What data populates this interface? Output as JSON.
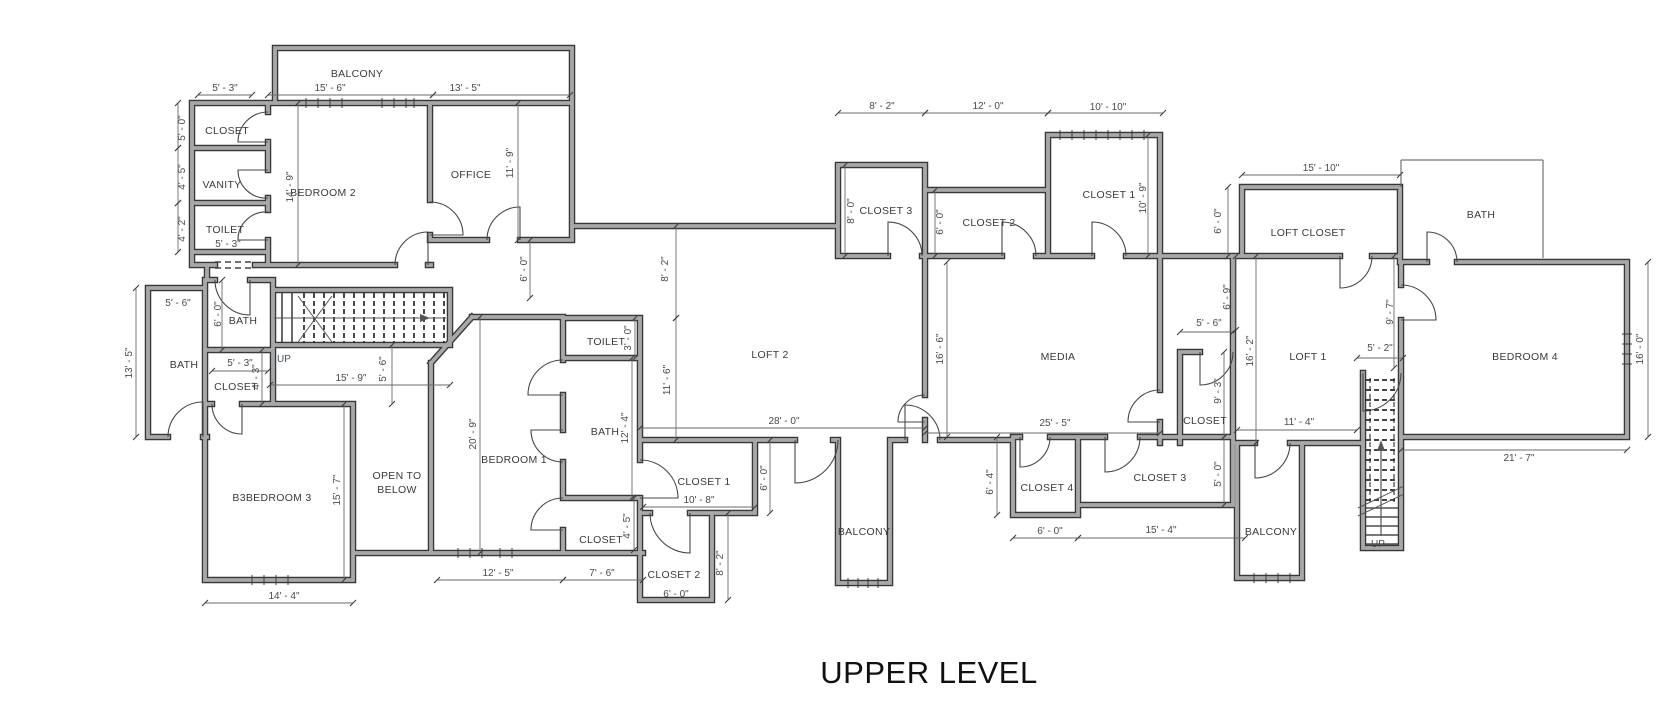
{
  "title": {
    "text": "UPPER LEVEL"
  },
  "colors": {
    "background": "#ffffff",
    "wall_edge": "#383838",
    "wall_core": "#a8a8a8",
    "thin_line": "#555555",
    "dim_text": "#4a4a4a",
    "room_text": "#3a3a3a"
  },
  "rooms": [
    {
      "label": "BALCONY",
      "x": 357,
      "y": 77
    },
    {
      "label": "CLOSET",
      "x": 227,
      "y": 134
    },
    {
      "label": "VANITY",
      "x": 222,
      "y": 188
    },
    {
      "label": "TOILET",
      "x": 225,
      "y": 233
    },
    {
      "label": "BEDROOM 2",
      "x": 323,
      "y": 196
    },
    {
      "label": "OFFICE",
      "x": 471,
      "y": 178
    },
    {
      "label": "BATH",
      "x": 243,
      "y": 324
    },
    {
      "label": "BATH",
      "x": 184,
      "y": 368
    },
    {
      "label": "CLOSET",
      "x": 236,
      "y": 390
    },
    {
      "label": "B3BEDROOM 3",
      "x": 272,
      "y": 501
    },
    {
      "label": "OPEN TO",
      "x": 397,
      "y": 479
    },
    {
      "label": "BELOW",
      "x": 397,
      "y": 493
    },
    {
      "label": "BEDROOM 1",
      "x": 514,
      "y": 463
    },
    {
      "label": "TOILET",
      "x": 606,
      "y": 345
    },
    {
      "label": "BATH",
      "x": 605,
      "y": 435
    },
    {
      "label": "CLOSET",
      "x": 601,
      "y": 543
    },
    {
      "label": "CLOSET 1",
      "x": 704,
      "y": 485
    },
    {
      "label": "10' - 8\"",
      "x": 699,
      "y": 503,
      "dimstyle": true
    },
    {
      "label": "CLOSET 2",
      "x": 674,
      "y": 578
    },
    {
      "label": "6' - 0\"",
      "x": 676,
      "y": 597,
      "dimstyle": true
    },
    {
      "label": "LOFT 2",
      "x": 770,
      "y": 358
    },
    {
      "label": "CLOSET 3",
      "x": 886,
      "y": 214
    },
    {
      "label": "CLOSET 2",
      "x": 989,
      "y": 226
    },
    {
      "label": "CLOSET 1",
      "x": 1109,
      "y": 198
    },
    {
      "label": "MEDIA",
      "x": 1058,
      "y": 360
    },
    {
      "label": "BALCONY",
      "x": 864,
      "y": 535
    },
    {
      "label": "CLOSET 4",
      "x": 1047,
      "y": 491
    },
    {
      "label": "CLOSET 3",
      "x": 1160,
      "y": 481
    },
    {
      "label": "CLOSET",
      "x": 1205,
      "y": 424
    },
    {
      "label": "LOFT CLOSET",
      "x": 1308,
      "y": 236
    },
    {
      "label": "LOFT 1",
      "x": 1308,
      "y": 360
    },
    {
      "label": "BALCONY",
      "x": 1271,
      "y": 535
    },
    {
      "label": "BATH",
      "x": 1481,
      "y": 218
    },
    {
      "label": "BEDROOM 4",
      "x": 1525,
      "y": 360
    }
  ],
  "dimensions": [
    {
      "label": "5' - 3\"",
      "x": 225,
      "y": 91,
      "rot": 0
    },
    {
      "label": "15' - 6\"",
      "x": 330,
      "y": 91,
      "rot": 0
    },
    {
      "label": "13' - 5\"",
      "x": 465,
      "y": 91,
      "rot": 0
    },
    {
      "label": "5' - 3\"",
      "x": 228,
      "y": 247,
      "rot": 0
    },
    {
      "label": "5' - 6\"",
      "x": 178,
      "y": 306,
      "rot": 0
    },
    {
      "label": "5' - 3\"",
      "x": 240,
      "y": 366,
      "rot": 0
    },
    {
      "label": "15' - 9\"",
      "x": 351,
      "y": 381,
      "rot": 0
    },
    {
      "label": "14' - 4\"",
      "x": 284,
      "y": 599,
      "rot": 0
    },
    {
      "label": "12' - 5\"",
      "x": 498,
      "y": 576,
      "rot": 0
    },
    {
      "label": "7' - 6\"",
      "x": 602,
      "y": 576,
      "rot": 0
    },
    {
      "label": "28' - 0\"",
      "x": 784,
      "y": 424,
      "rot": 0
    },
    {
      "label": "8' - 2\"",
      "x": 882,
      "y": 109,
      "rot": 0
    },
    {
      "label": "12' - 0\"",
      "x": 988,
      "y": 109,
      "rot": 0
    },
    {
      "label": "10' - 10\"",
      "x": 1108,
      "y": 110,
      "rot": 0
    },
    {
      "label": "25' - 5\"",
      "x": 1055,
      "y": 426,
      "rot": 0
    },
    {
      "label": "6' - 0\"",
      "x": 1050,
      "y": 534,
      "rot": 0
    },
    {
      "label": "15' - 4\"",
      "x": 1161,
      "y": 533,
      "rot": 0
    },
    {
      "label": "5' - 6\"",
      "x": 1209,
      "y": 326,
      "rot": 0
    },
    {
      "label": "15' - 10\"",
      "x": 1321,
      "y": 171,
      "rot": 0
    },
    {
      "label": "5' - 2\"",
      "x": 1380,
      "y": 351,
      "rot": 0
    },
    {
      "label": "11' - 4\"",
      "x": 1299,
      "y": 425,
      "rot": 0
    },
    {
      "label": "21' - 7\"",
      "x": 1519,
      "y": 461,
      "rot": 0
    },
    {
      "label": "5' - 0\"",
      "x": 185,
      "y": 128,
      "rot": 1
    },
    {
      "label": "4' - 5\"",
      "x": 185,
      "y": 177,
      "rot": 1
    },
    {
      "label": "4' - 2\"",
      "x": 185,
      "y": 229,
      "rot": 1
    },
    {
      "label": "14' - 9\"",
      "x": 293,
      "y": 187,
      "rot": 1
    },
    {
      "label": "11' - 9\"",
      "x": 513,
      "y": 163,
      "rot": 1
    },
    {
      "label": "6' - 0\"",
      "x": 527,
      "y": 269,
      "rot": 1
    },
    {
      "label": "6' - 0\"",
      "x": 221,
      "y": 314,
      "rot": 1
    },
    {
      "label": "13' - 5\"",
      "x": 132,
      "y": 363,
      "rot": 1
    },
    {
      "label": "4' - 3\"",
      "x": 259,
      "y": 377,
      "rot": 1
    },
    {
      "label": "5' - 6\"",
      "x": 386,
      "y": 369,
      "rot": 1
    },
    {
      "label": "15' - 7\"",
      "x": 340,
      "y": 490,
      "rot": 1
    },
    {
      "label": "20' - 9\"",
      "x": 476,
      "y": 434,
      "rot": 1
    },
    {
      "label": "3' - 0\"",
      "x": 631,
      "y": 338,
      "rot": 1
    },
    {
      "label": "12' - 4\"",
      "x": 628,
      "y": 428,
      "rot": 1
    },
    {
      "label": "4' - 5\"",
      "x": 630,
      "y": 526,
      "rot": 1
    },
    {
      "label": "8' - 2\"",
      "x": 668,
      "y": 269,
      "rot": 1
    },
    {
      "label": "11' - 6\"",
      "x": 670,
      "y": 380,
      "rot": 1
    },
    {
      "label": "6' - 0\"",
      "x": 767,
      "y": 478,
      "rot": 1
    },
    {
      "label": "8' - 2\"",
      "x": 723,
      "y": 563,
      "rot": 1
    },
    {
      "label": "8' - 0\"",
      "x": 854,
      "y": 211,
      "rot": 1
    },
    {
      "label": "6' - 0\"",
      "x": 943,
      "y": 222,
      "rot": 1
    },
    {
      "label": "10' - 9\"",
      "x": 1146,
      "y": 198,
      "rot": 1
    },
    {
      "label": "16' - 6\"",
      "x": 943,
      "y": 349,
      "rot": 1
    },
    {
      "label": "16' - 2\"",
      "x": 1253,
      "y": 351,
      "rot": 1
    },
    {
      "label": "6' - 4\"",
      "x": 993,
      "y": 482,
      "rot": 1
    },
    {
      "label": "5' - 0\"",
      "x": 1221,
      "y": 474,
      "rot": 1
    },
    {
      "label": "9' - 3\"",
      "x": 1221,
      "y": 391,
      "rot": 1
    },
    {
      "label": "6' - 0\"",
      "x": 1221,
      "y": 221,
      "rot": 1
    },
    {
      "label": "6' - 9\"",
      "x": 1230,
      "y": 297,
      "rot": 1
    },
    {
      "label": "9' - 7\"",
      "x": 1393,
      "y": 312,
      "rot": 1
    },
    {
      "label": "16' - 0\"",
      "x": 1643,
      "y": 349,
      "rot": 1
    }
  ],
  "stairs": [
    {
      "label": "UP",
      "x": 284,
      "y": 362
    },
    {
      "label": "UP",
      "x": 1378,
      "y": 547
    }
  ]
}
